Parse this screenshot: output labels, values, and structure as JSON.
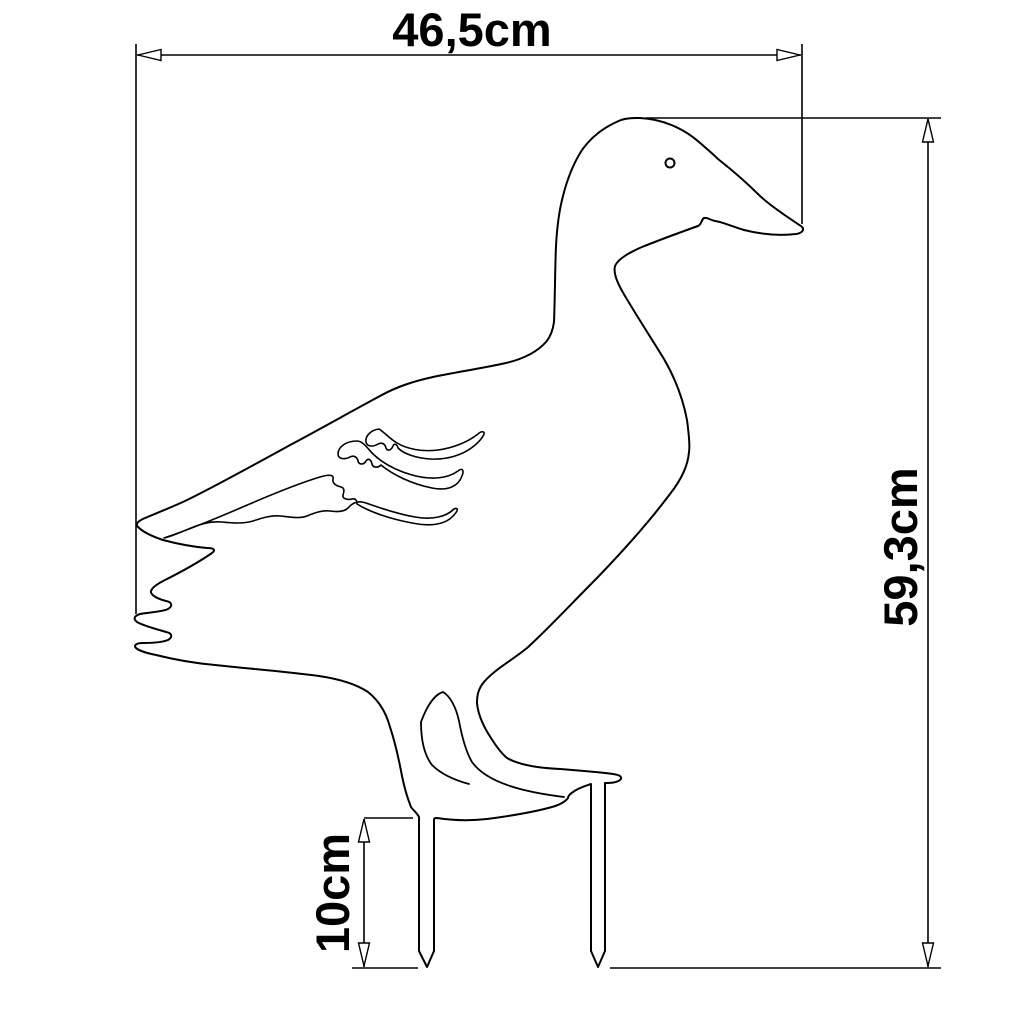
{
  "drawing": {
    "type": "technical-dimension-drawing",
    "subject": "duck-garden-stake-silhouette",
    "background_color": "#ffffff",
    "line_color": "#000000",
    "dimensions": {
      "width_label": "46,5cm",
      "height_label": "59,3cm",
      "stake_label": "10cm"
    }
  }
}
